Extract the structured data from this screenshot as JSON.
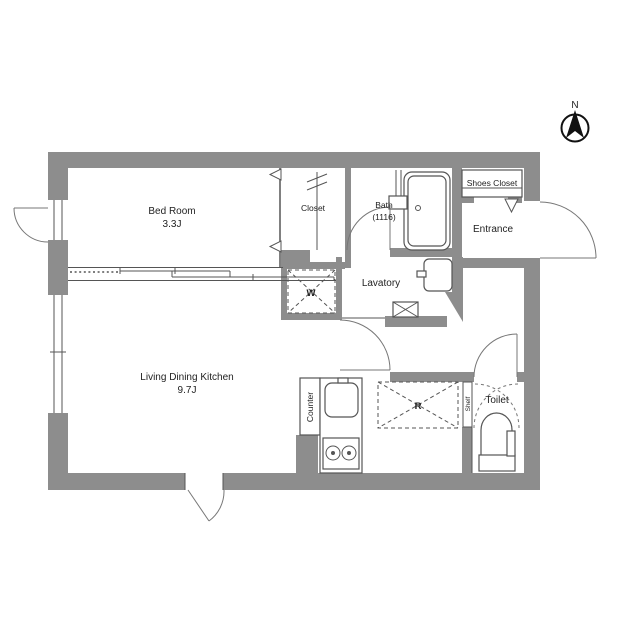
{
  "plan": {
    "compass": {
      "north_label": "N"
    },
    "rooms": {
      "bedroom": {
        "name": "Bed Room",
        "size": "3.3J"
      },
      "closet": {
        "name": "Closet"
      },
      "bath": {
        "name": "Bath",
        "size": "(1116)"
      },
      "shoes_closet": {
        "name": "Shoes Closet"
      },
      "entrance": {
        "name": "Entrance"
      },
      "lavatory": {
        "name": "Lavatory"
      },
      "washing_machine": {
        "abbr": "W"
      },
      "ldk": {
        "name": "Living Dining Kitchen",
        "size": "9.7J"
      },
      "counter": {
        "name": "Counter"
      },
      "refrigerator": {
        "abbr": "R"
      },
      "shelf": {
        "name": "Shelf"
      },
      "toilet": {
        "name": "Toilet"
      }
    },
    "colors": {
      "wall": "#8d8d8d",
      "line": "#555555",
      "text": "#222222",
      "background": "#ffffff"
    }
  }
}
